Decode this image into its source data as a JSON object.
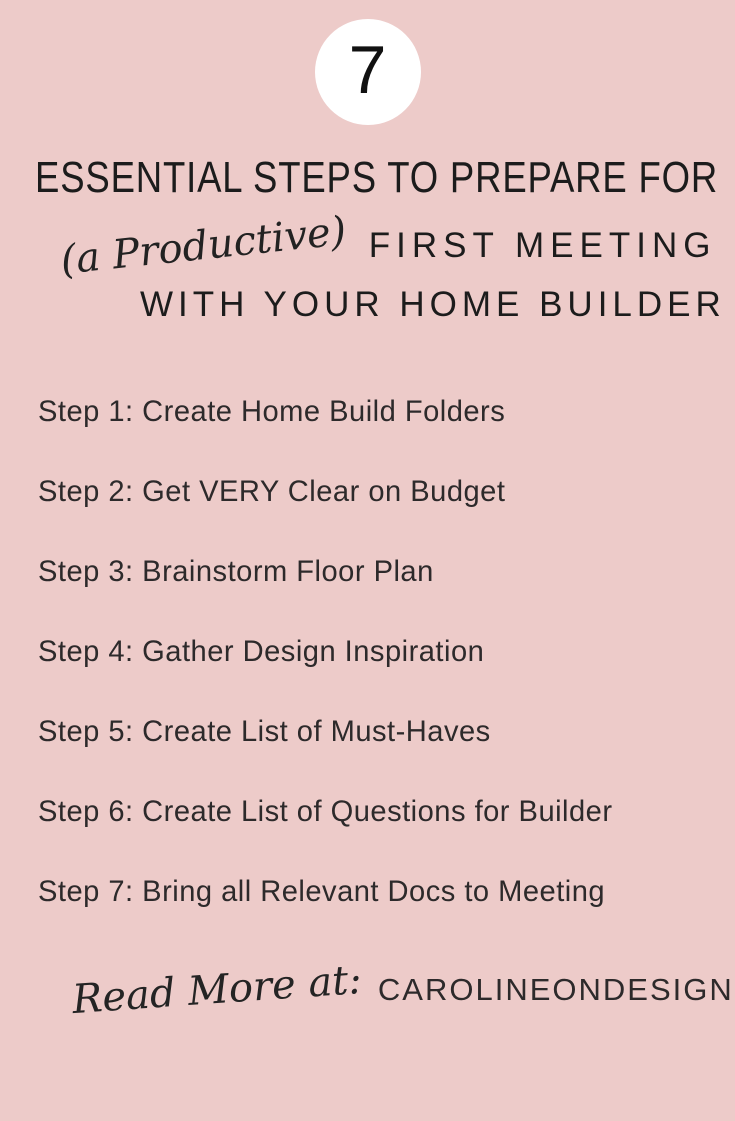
{
  "badge": {
    "number": "7"
  },
  "title": {
    "line1": "ESSENTIAL STEPS TO PREPARE FOR",
    "line2_script": "(a Productive)",
    "line2_caps": "FIRST MEETING",
    "line3": "WITH YOUR HOME BUILDER"
  },
  "steps": [
    "Step 1: Create Home Build Folders",
    "Step 2: Get VERY Clear on Budget",
    "Step 3: Brainstorm Floor Plan",
    "Step 4: Gather Design Inspiration",
    "Step 5: Create List of Must-Haves",
    "Step 6: Create List of Questions for Builder",
    "Step 7: Bring all Relevant Docs to Meeting"
  ],
  "footer": {
    "script_text": "Read More at:",
    "site": "CAROLINEONDESIGN.COM"
  },
  "colors": {
    "background": "#edcbc9",
    "badge_background": "#ffffff",
    "title_text": "#1c1c1c",
    "body_text": "#2d2a2b"
  }
}
